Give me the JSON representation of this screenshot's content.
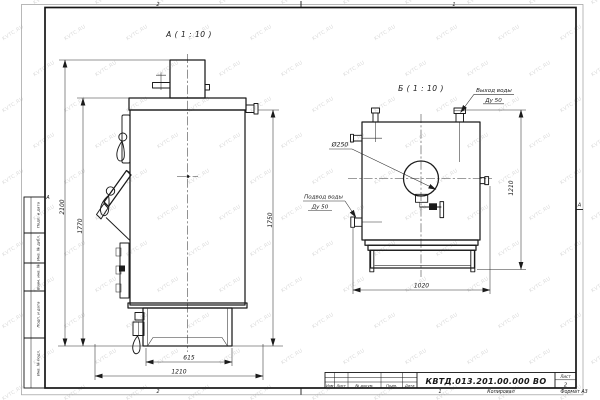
{
  "sheet": {
    "watermark": "KVTC.RU",
    "zone_top_left": "2",
    "zone_top_right": "1",
    "zone_bottom_left": "2",
    "zone_bottom_right": "1",
    "zone_left": "А",
    "zone_right": "А"
  },
  "view_a": {
    "title": "А ( 1 : 10 )",
    "dim_overall_height": "2100",
    "dim_front_height": "1770",
    "dim_rear_height": "1750",
    "dim_base_width": "615",
    "dim_overall_width": "1210"
  },
  "view_b": {
    "title": "Б ( 1 : 10 )",
    "outlet_line1": "Выход воды",
    "outlet_line2": "Ду 50",
    "inlet_line1": "Подвод воды",
    "inlet_line2": "Ду 50",
    "dim_flue_diameter": "Ø250",
    "dim_height": "1210",
    "dim_width": "1020"
  },
  "title_block": {
    "doc_number": "КВТД.013.201.00.000 ВО",
    "sheet_label": "Лист",
    "sheet_value": "2",
    "col_izm": "Изм",
    "col_list": "Лист",
    "col_doc": "№ докум.",
    "col_podp": "Подп.",
    "col_data": "Дата",
    "footer_copied": "Копировал",
    "footer_format": "Формат А3"
  },
  "stamp_column": {
    "labels": [
      "Подп. и дата",
      "Инв. № дубл.",
      "Взам. инв. №",
      "Подп. и дата",
      "Инв. № подл."
    ]
  }
}
